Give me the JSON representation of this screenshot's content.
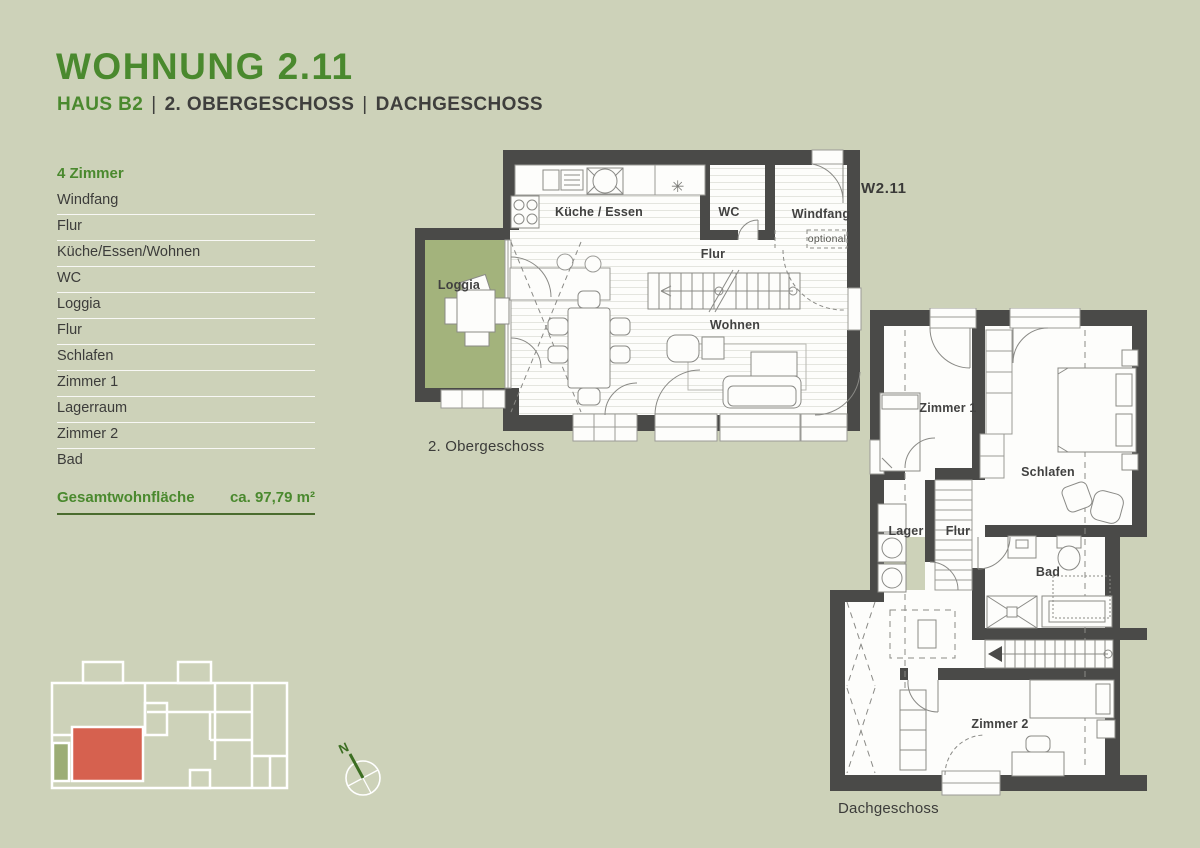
{
  "header": {
    "title": "WOHNUNG 2.11",
    "subtitle": {
      "house": "HAUS B2",
      "separator": "|",
      "floor1": "2. OBERGESCHOSS",
      "floor2": "DACHGESCHOSS"
    }
  },
  "room_list": {
    "header": "4 Zimmer",
    "items": [
      "Windfang",
      "Flur",
      "Küche/Essen/Wohnen",
      "WC",
      "Loggia",
      "Flur",
      "Schlafen",
      "Zimmer 1",
      "Lagerraum",
      "Zimmer 2",
      "Bad"
    ]
  },
  "total_area": {
    "label": "Gesamtwohnfläche",
    "value": "ca. 97,79 m²"
  },
  "plan_obergeschoss": {
    "caption": "2. Obergeschoss",
    "unit_label": "W2.11",
    "labels": {
      "kueche": "Küche / Essen",
      "wc": "WC",
      "windfang": "Windfang",
      "optional": "optional",
      "flur": "Flur",
      "wohnen": "Wohnen",
      "loggia": "Loggia"
    }
  },
  "plan_dachgeschoss": {
    "caption": "Dachgeschoss",
    "labels": {
      "zimmer1": "Zimmer 1",
      "schlafen": "Schlafen",
      "lager": "Lager",
      "flur": "Flur",
      "bad": "Bad",
      "zimmer2": "Zimmer 2"
    }
  },
  "compass": {
    "north_label": "N"
  },
  "icons": {
    "freezer": "✳"
  },
  "colors": {
    "background": "#cdd2b9",
    "accent_green": "#4a892e",
    "underline_green": "#4a6c2e",
    "wall": "#4a4a48",
    "loggia": "#a3b37c",
    "minimap_red": "#d6614f",
    "minimap_green": "#9cad75",
    "text": "#3c3c3a"
  }
}
